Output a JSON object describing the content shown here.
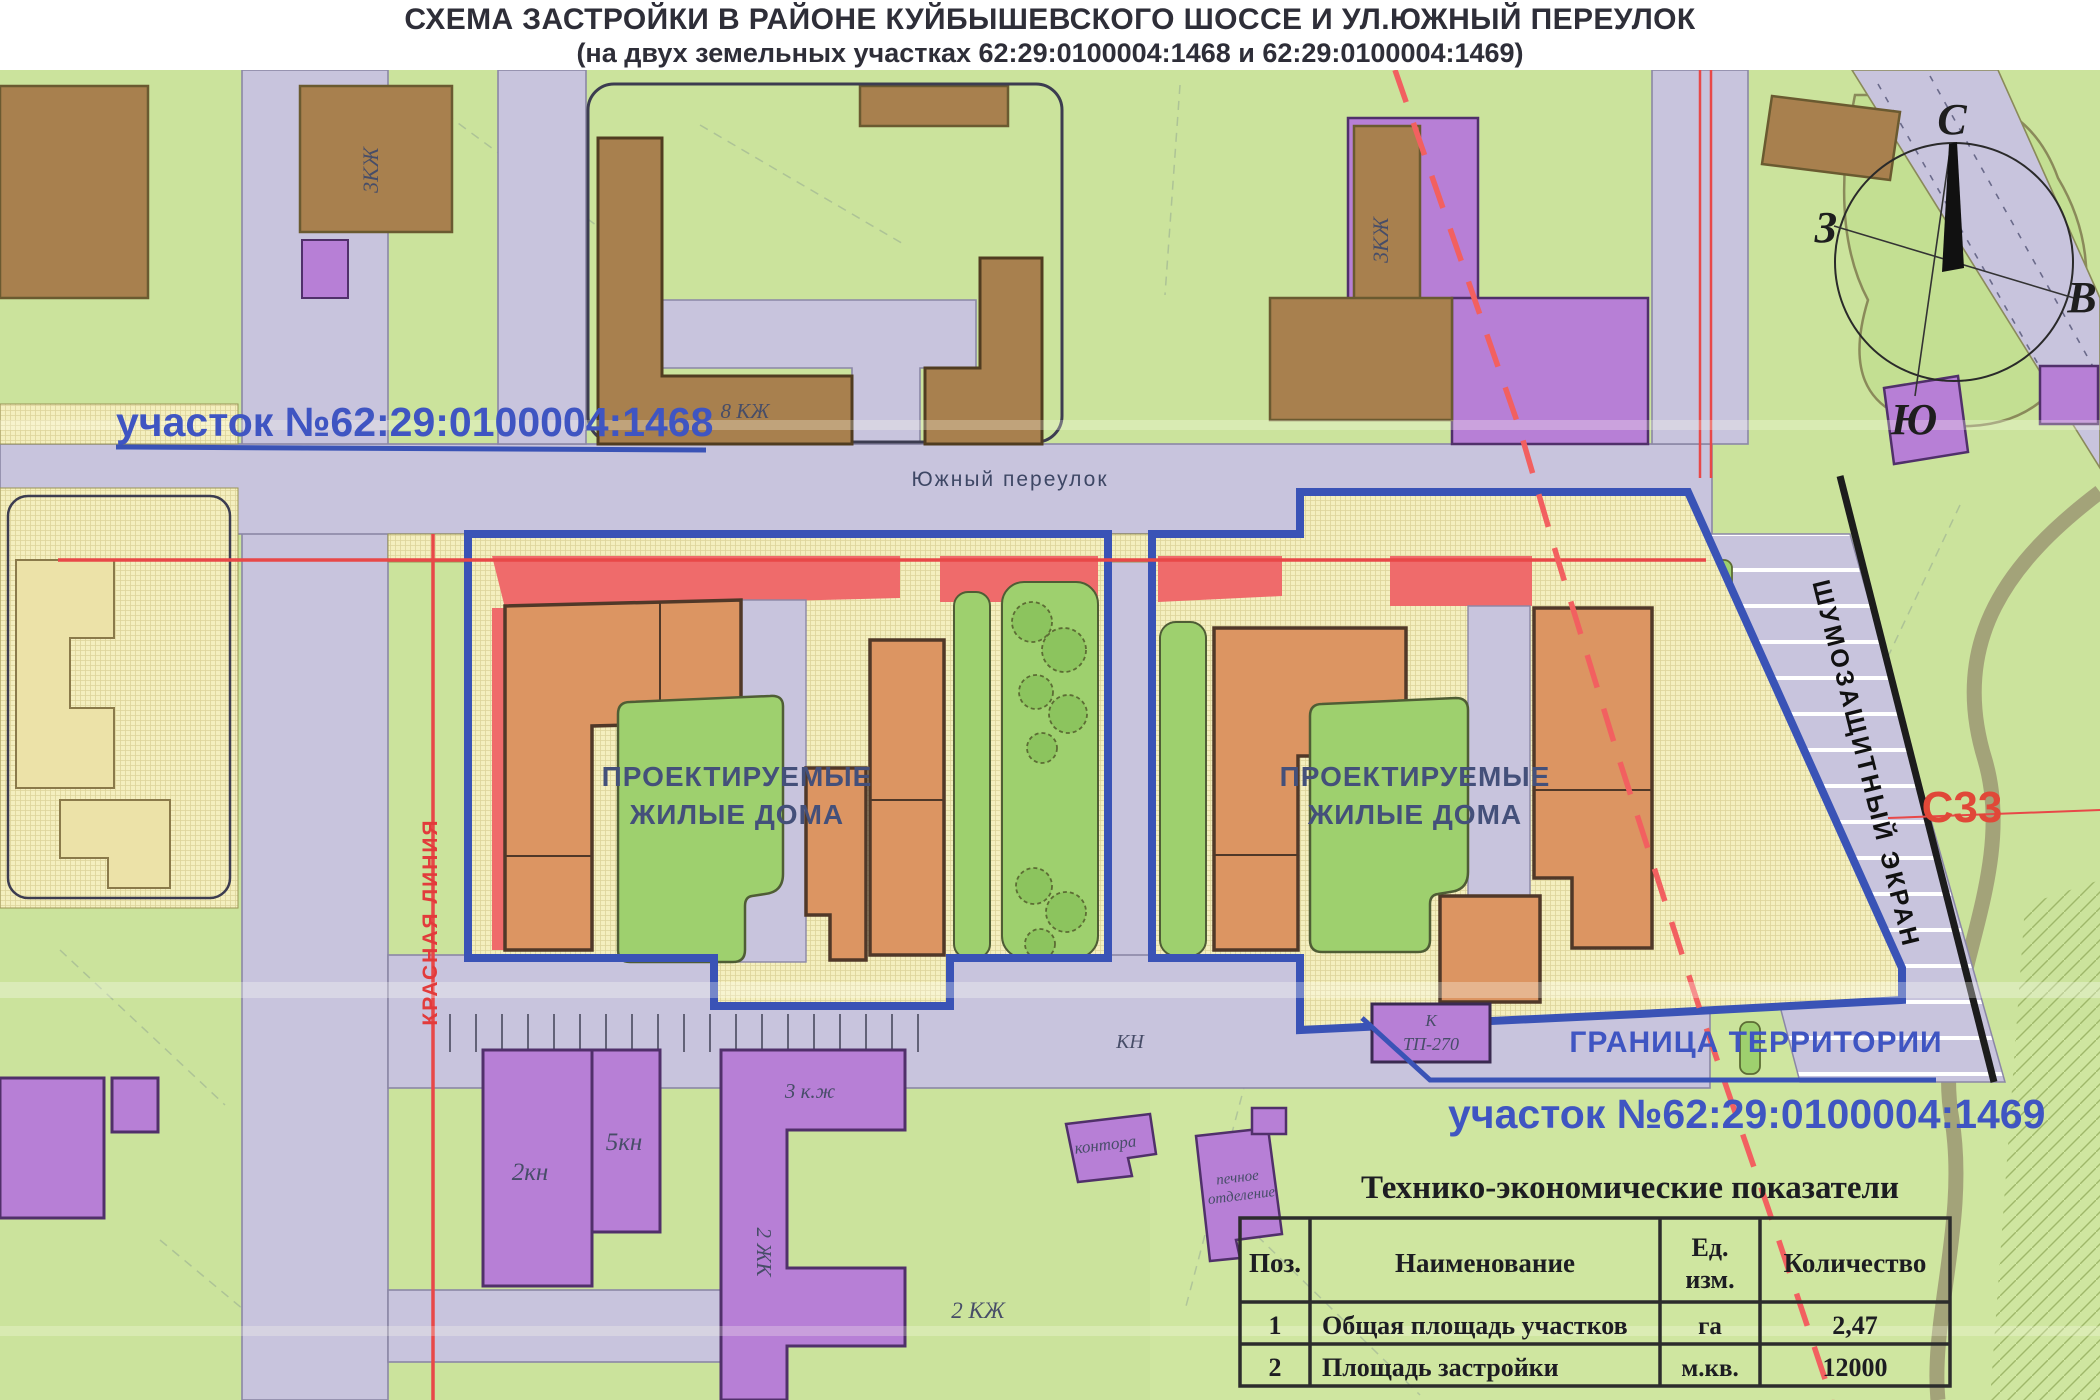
{
  "title": {
    "line1": "СХЕМА ЗАСТРОЙКИ В РАЙОНЕ КУЙБЫШЕВСКОГО ШОССЕ И УЛ.ЮЖНЫЙ ПЕРЕУЛОК",
    "line2": "(на двух земельных участках 62:29:0100004:1468 и 62:29:0100004:1469)"
  },
  "map": {
    "parcel_1468_label": "участок №62:29:0100004:1468",
    "parcel_1469_label": "участок №62:29:0100004:1469",
    "territory_boundary_label": "ГРАНИЦА ТЕРРИТОРИИ",
    "projected_housing": {
      "line1": "ПРОЕКТИРУЕМЫЕ",
      "line2": "ЖИЛЫЕ ДОМА"
    },
    "street_label": "Южный переулок",
    "red_line_label": "КРАСНАЯ ЛИНИЯ",
    "noise_screen_label": "ШУМОЗАЩИТНЫЙ ЭКРАН",
    "grid_mark": "С33",
    "compass": {
      "north": "С",
      "south": "Ю",
      "west": "З",
      "east": "В"
    },
    "building_labels": {
      "b3kzh_left": "3КЖ",
      "b3kzh_right": "3КЖ",
      "b8kzh": "8 КЖ",
      "b2kn": "2кн",
      "b5kn": "5кн",
      "b3kzh_small": "3 к.ж",
      "b2zhk_vert": "2 ЖК",
      "b2kzh": "2 КЖ",
      "kn": "КН",
      "kontora": "контора",
      "pechnoe_line1": "печное",
      "pechnoe_line2": "отделение",
      "k": "К",
      "tp": "ТП-270"
    }
  },
  "table": {
    "title": "Технико-экономические показатели",
    "headers": {
      "pos": "Поз.",
      "name": "Наименование",
      "unit_line1": "Ед.",
      "unit_line2": "изм.",
      "qty": "Количество"
    },
    "rows": [
      {
        "pos": "1",
        "name": "Общая площадь участков",
        "unit": "га",
        "qty": "2,47"
      },
      {
        "pos": "2",
        "name": "Площадь застройки",
        "unit": "м.кв.",
        "qty": "12000"
      }
    ]
  },
  "colors": {
    "parcel_boundary_blue": "#3a53b6",
    "label_blue": "#3f55c2",
    "building_orange": "#dc9562",
    "building_brown": "#a8804e",
    "building_purple": "#b77fd6",
    "red_line": "#e84848",
    "red_strip": "#ef6b6b",
    "courtyard_green": "#9ed06e",
    "map_green": "#cbe39c",
    "road_lavender": "#c8c4dd",
    "parcel_yellow": "#f4efbf"
  }
}
